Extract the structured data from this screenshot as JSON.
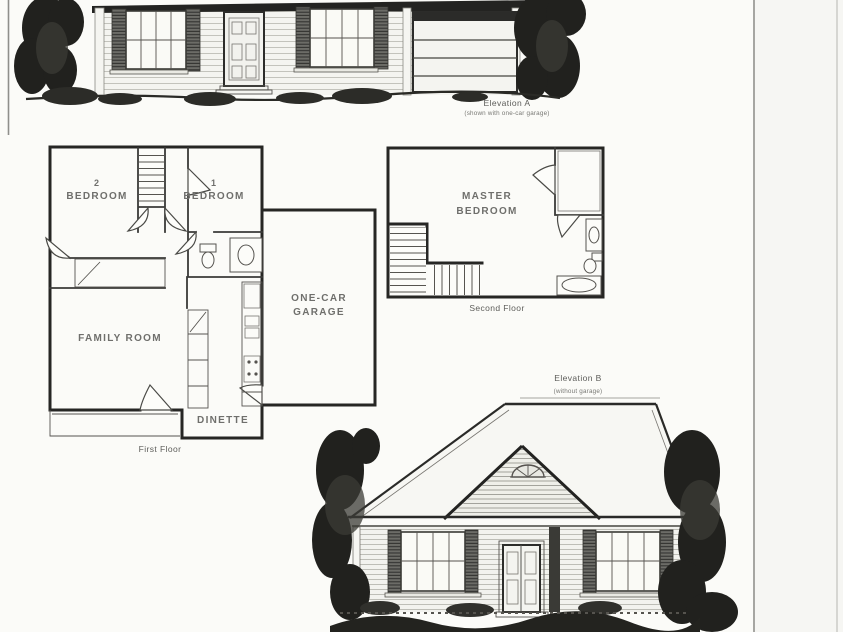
{
  "colors": {
    "paper": "#fbfbf8",
    "ink": "#232321",
    "wall": "#262624",
    "label": "#6f6f6c",
    "caption": "#5d5d5a"
  },
  "elevation_a": {
    "caption": "Elevation A",
    "subcaption": "(shown with one-car garage)"
  },
  "first_floor": {
    "caption": "First Floor",
    "bedroom2_number": "2",
    "bedroom2_label": "BEDROOM",
    "bedroom1_number": "1",
    "bedroom1_label": "BEDROOM",
    "family_room": "FAMILY ROOM",
    "dinette": "DINETTE",
    "garage_line1": "ONE-CAR",
    "garage_line2": "GARAGE"
  },
  "second_floor": {
    "caption": "Second Floor",
    "master_line1": "MASTER",
    "master_line2": "BEDROOM"
  },
  "elevation_b": {
    "caption": "Elevation B",
    "subcaption": "(without garage)"
  }
}
